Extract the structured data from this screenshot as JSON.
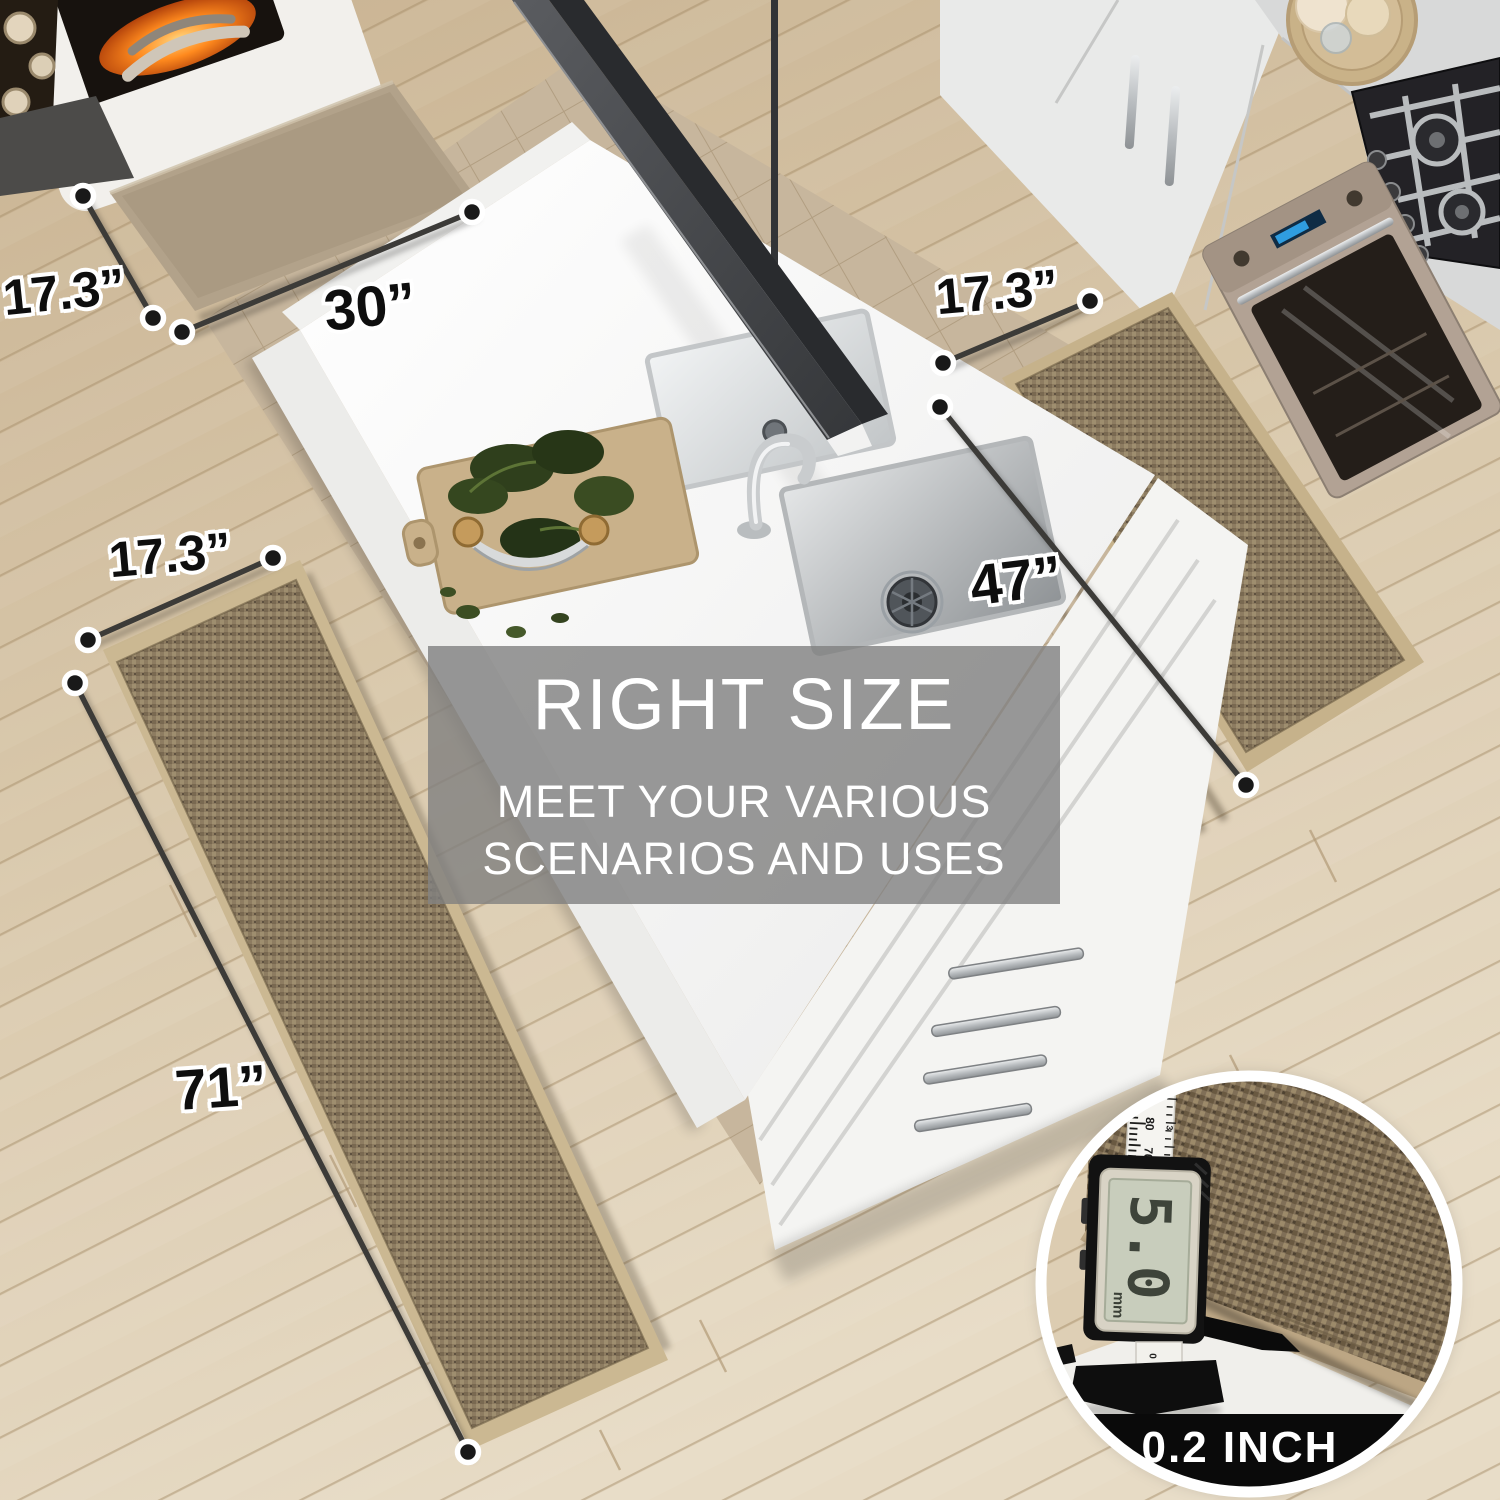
{
  "overlay_band": {
    "title": "RIGHT SIZE",
    "line1": "MEET YOUR VARIOUS",
    "line2": "SCENARIOS AND USES"
  },
  "dimensions": {
    "top_mat": {
      "width": "17.3”",
      "length": "30”"
    },
    "right_runner": {
      "width": "17.3”",
      "length": "47”"
    },
    "left_runner": {
      "width": "17.3”",
      "length": "71”"
    }
  },
  "inset": {
    "caption": "0.2 INCH",
    "lcd_value": "5.0",
    "lcd_unit": "mm",
    "ruler_numbers": [
      "90",
      "80",
      "70"
    ],
    "ruler_inch_number": "3",
    "ruler_zero": "0"
  },
  "colors": {
    "overlay_gray": "#7f7f7f",
    "annotation_line": "#3c3b38",
    "annotation_text": "#0e0e0e",
    "annotation_outline": "#ffffff",
    "caption_bg": "#0a0a0a",
    "caption_text": "#ffffff",
    "rug": "#8d7c61",
    "rug_border": "#c9b58f",
    "floor": "#d9c8ac",
    "island": "#f8f8f7"
  }
}
